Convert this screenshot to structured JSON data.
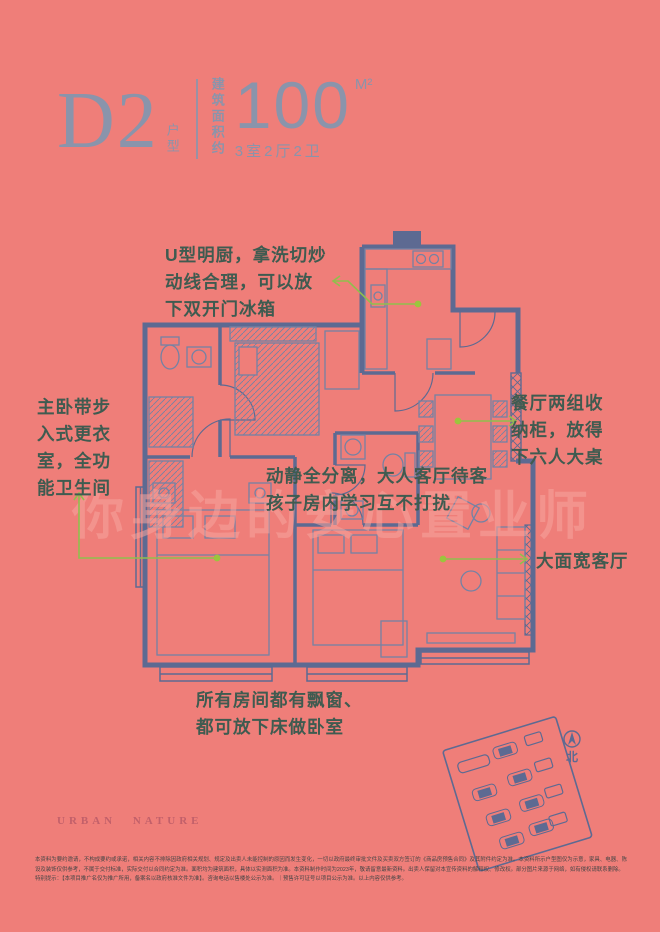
{
  "header": {
    "plan_code": "D2",
    "plan_code_suffix": "户型",
    "area_label": "建筑面积约",
    "area_value": "100",
    "area_unit": "M²",
    "rooms_spec": "3室2厅2卫"
  },
  "annotations": {
    "kitchen": "U型明厨，拿洗切炒\n动线合理，可以放\n下双开门冰箱",
    "master": "主卧带步\n入式更衣\n室，全功\n能卫生间",
    "dining": "餐厅两组收\n纳柜，放得\n下六人大桌",
    "separation": "动静全分离，大人客厅待客\n孩子房内学习互不打扰",
    "living": "大面宽客厅",
    "baywindow": "所有房间都有飘窗、\n都可放下床做卧室"
  },
  "watermark": "你身边的安心置业师",
  "footer": {
    "brand": "URBAN NATURE",
    "compass_north": "北",
    "disclaimer": "本资料为要约邀请，不构成要约或承诺，相关内容不排除因政府相关规划、规定及出卖人未能控制的原因而发生变化，一切以政府最终审批文件及买卖双方签订的《商品房预售合同》及其附件约定为准。本资料所示户型图仅为示意，家具、电器、陈设及装饰仅供参考，不属于交付标准，实际交付以合同约定为准。面积均为建筑面积，具体以实测面积为准。本资料制作时间为2023年，敬请留意最新资料。出卖人保留对本宣传资料的解释权、修改权。部分图片来源于网络，如有侵权请联系删除。\n特别提示：【本项目推广名仅为推广所用，备案名以政府核准文件为准】。咨询电话以售楼处公示为准。｜预售许可证号以项目公示为准。以上内容仅供参考。"
  },
  "colors": {
    "background": "#EF7E79",
    "plan_line": "#5D6A92",
    "furniture_line": "#7482A4",
    "heading": "#8A94AB",
    "annotation_text": "#3F5B50",
    "leader_green": "#8FBF4D",
    "brand_red": "#C2606A"
  }
}
